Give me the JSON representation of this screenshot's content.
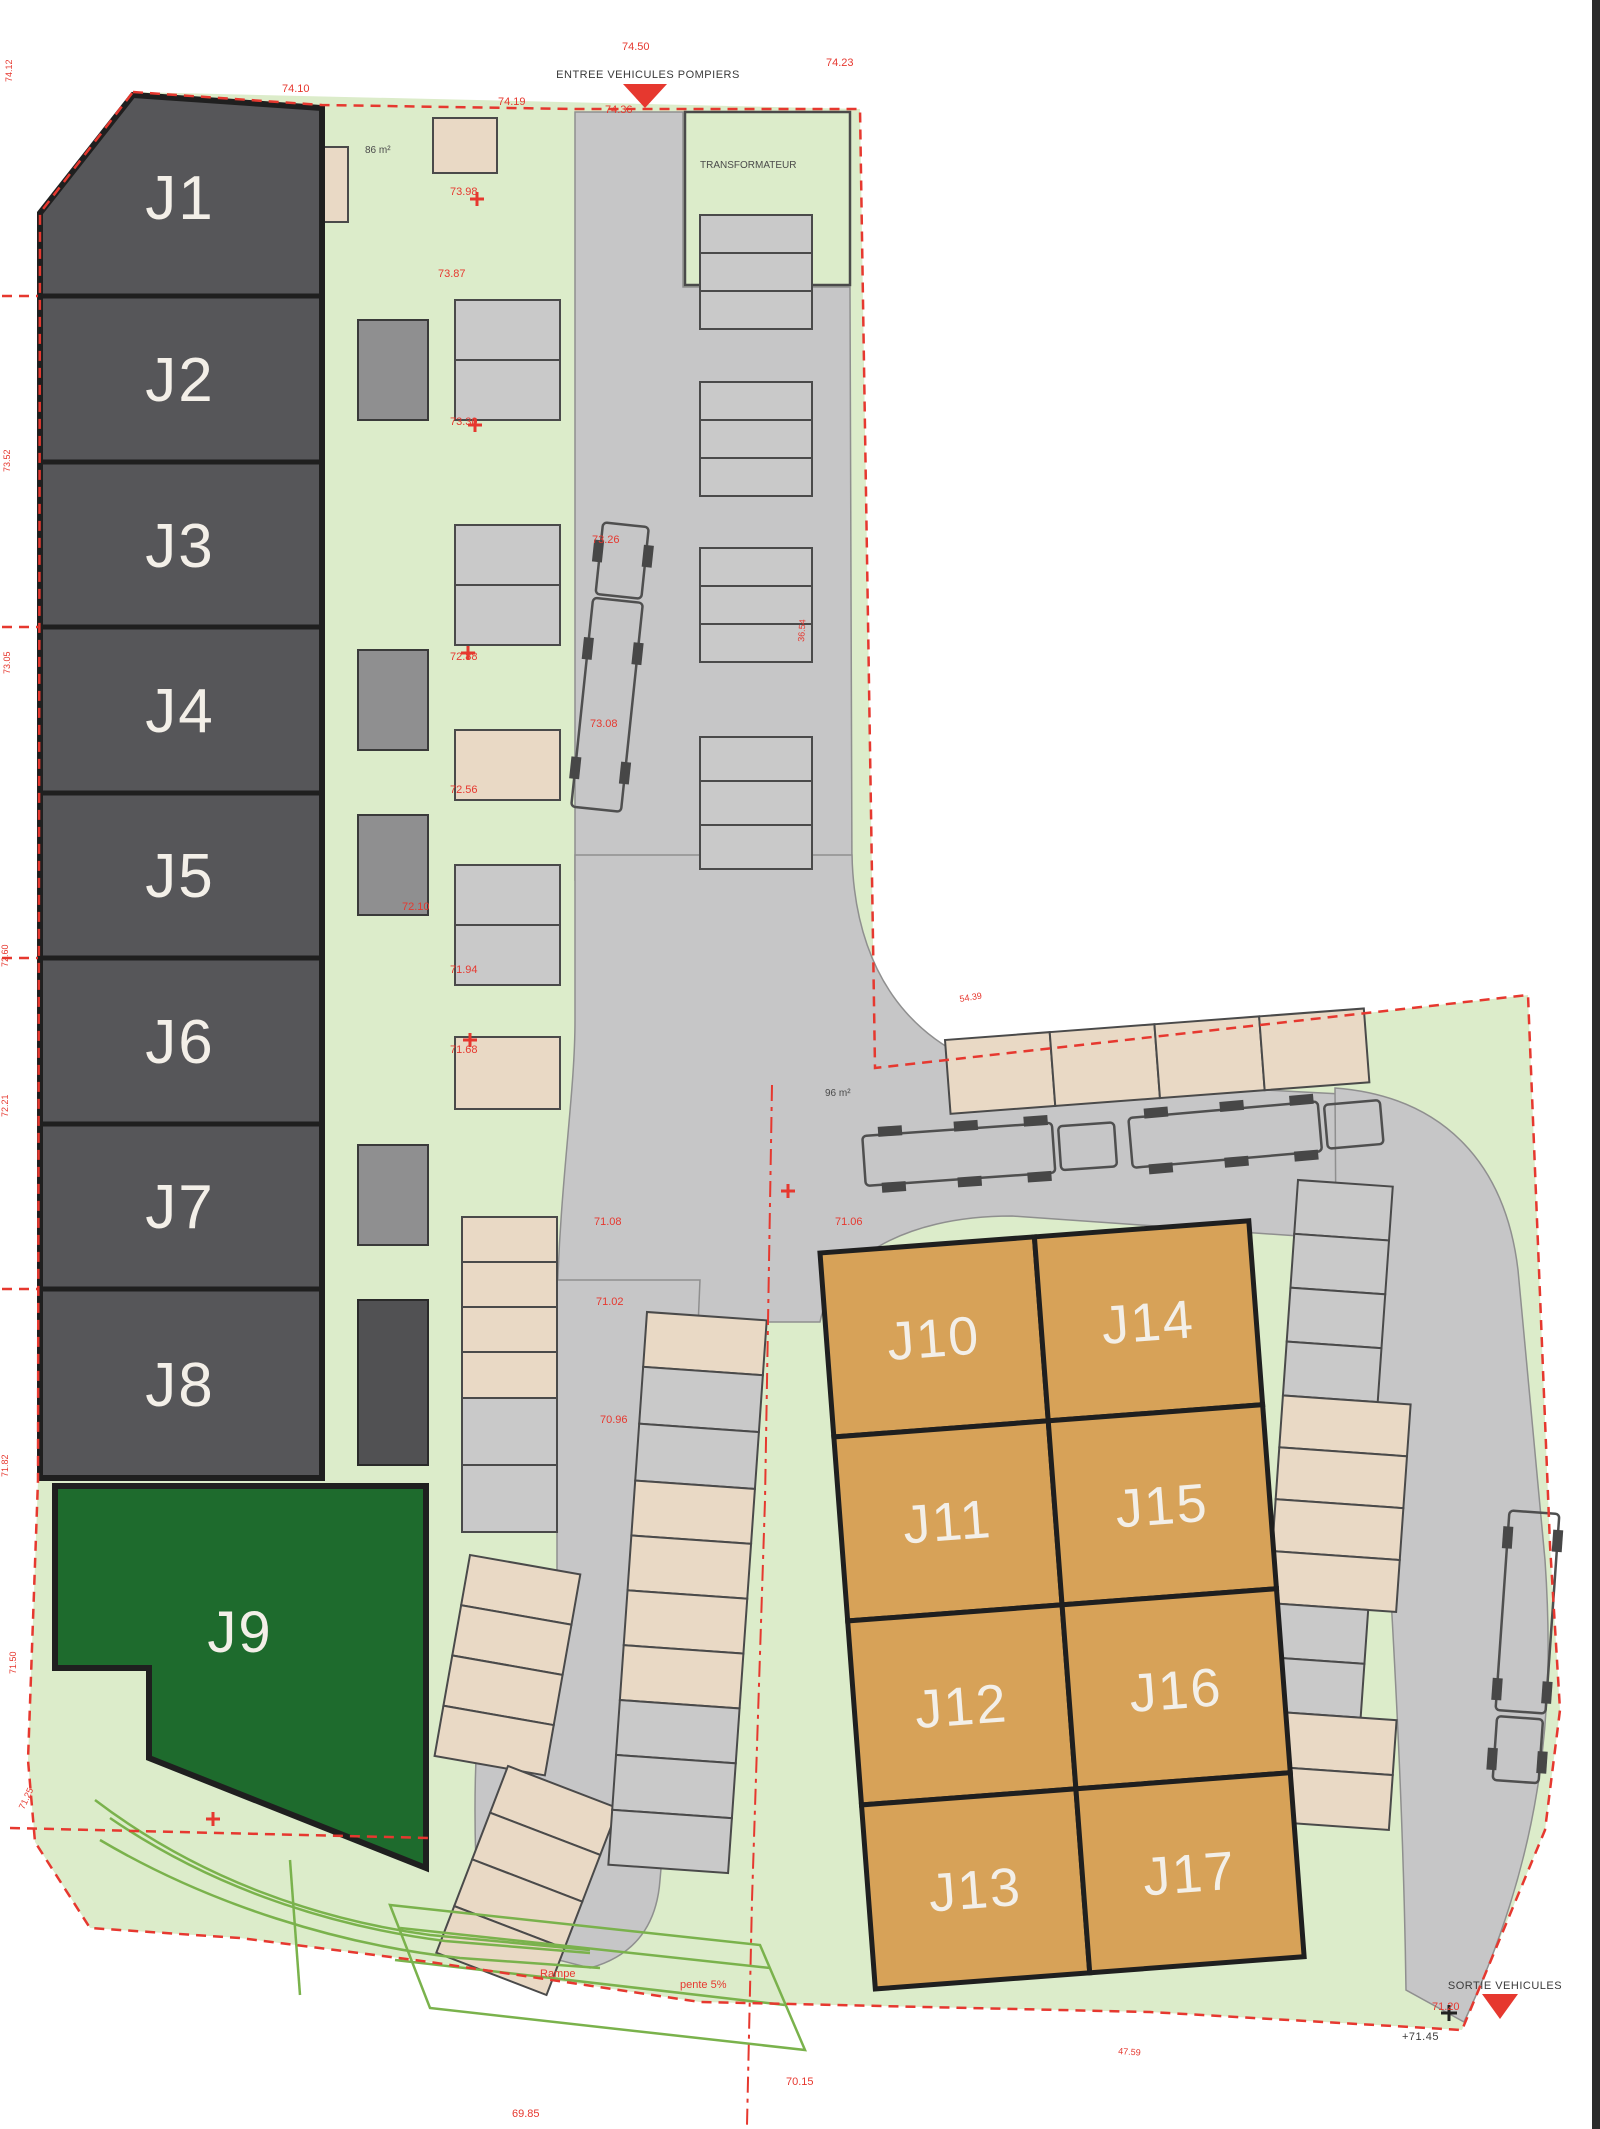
{
  "colors": {
    "dark": "#565659",
    "green9": "#1e6b2d",
    "orange": "#d7a258",
    "road": "#c6c6c7",
    "bg": "#dcecca",
    "beige": "#e9d9c5",
    "stall": "#c9c9c9",
    "red": "#e6382f",
    "swale": "#7ab24c"
  },
  "units": [
    {
      "label": "J1",
      "status": "dark"
    },
    {
      "label": "J2",
      "status": "dark"
    },
    {
      "label": "J3",
      "status": "dark"
    },
    {
      "label": "J4",
      "status": "dark"
    },
    {
      "label": "J5",
      "status": "dark"
    },
    {
      "label": "J6",
      "status": "dark"
    },
    {
      "label": "J7",
      "status": "dark"
    },
    {
      "label": "J8",
      "status": "dark"
    },
    {
      "label": "J9",
      "status": "green"
    },
    {
      "label": "J10",
      "status": "orange"
    },
    {
      "label": "J11",
      "status": "orange"
    },
    {
      "label": "J12",
      "status": "orange"
    },
    {
      "label": "J13",
      "status": "orange"
    },
    {
      "label": "J14",
      "status": "orange"
    },
    {
      "label": "J15",
      "status": "orange"
    },
    {
      "label": "J16",
      "status": "orange"
    },
    {
      "label": "J17",
      "status": "orange"
    }
  ],
  "labels": {
    "transformer": "TRANSFORMATEUR",
    "entrance": "ENTREE VEHICULES POMPIERS",
    "exit": "SORTIE VEHICULES",
    "area_small_1": "86 m²",
    "area_small_2": "96 m²",
    "ramp": "Rampe",
    "slope": "pente 5%",
    "exit_level": "+71.45"
  },
  "elevations": [
    {
      "v": "74.50"
    },
    {
      "v": "74.36"
    },
    {
      "v": "74.23"
    },
    {
      "v": "74.19"
    },
    {
      "v": "74.10"
    },
    {
      "v": "73.98"
    },
    {
      "v": "73.87"
    },
    {
      "v": "73.30"
    },
    {
      "v": "73.26"
    },
    {
      "v": "73.08"
    },
    {
      "v": "72.88"
    },
    {
      "v": "72.56"
    },
    {
      "v": "72.10"
    },
    {
      "v": "71.94"
    },
    {
      "v": "71.68"
    },
    {
      "v": "71.08"
    },
    {
      "v": "71.02"
    },
    {
      "v": "71.06"
    },
    {
      "v": "70.96"
    },
    {
      "v": "71.20"
    },
    {
      "v": "69.85"
    },
    {
      "v": "70.15"
    },
    {
      "v": "74.12"
    },
    {
      "v": "73.52"
    },
    {
      "v": "73.05"
    },
    {
      "v": "72.60"
    },
    {
      "v": "72.21"
    },
    {
      "v": "71.82"
    },
    {
      "v": "71.50"
    },
    {
      "v": "71.25"
    },
    {
      "v": "54.39"
    },
    {
      "v": "36.54"
    },
    {
      "v": "47.59"
    }
  ]
}
